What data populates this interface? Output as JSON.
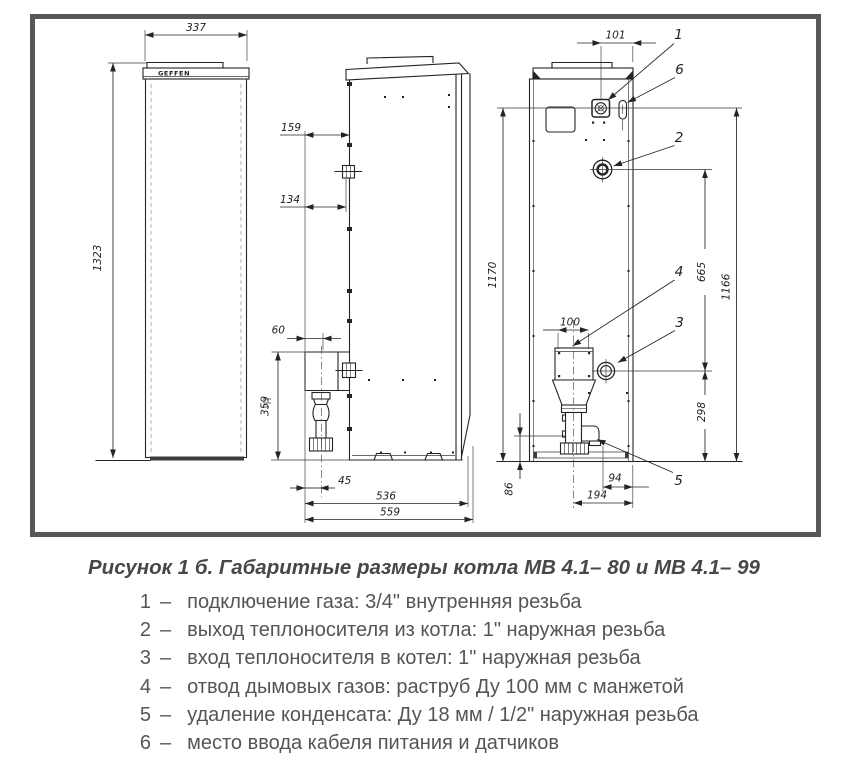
{
  "figure": {
    "border_color": "#58585a",
    "logo": "GEFFEN"
  },
  "dims": {
    "v337": "337",
    "v1323": "1323",
    "v159": "159",
    "v134": "134",
    "v60": "60",
    "v359": "359",
    "v45": "45",
    "v536": "536",
    "v559": "559",
    "v101": "101",
    "v1170": "1170",
    "v665": "665",
    "v1166": "1166",
    "v100": "100",
    "v298": "298",
    "v86": "86",
    "v94": "94",
    "v194": "194"
  },
  "callouts": {
    "n1": "1",
    "n2": "2",
    "n3": "3",
    "n4": "4",
    "n5": "5",
    "n6": "6"
  },
  "caption": {
    "title": "Рисунок 1 б. Габаритные размеры котла МВ 4.1– 80 и МВ 4.1– 99"
  },
  "legend": {
    "separator": "–",
    "items": [
      {
        "num": "1",
        "text": "подключение газа: 3/4\" внутренняя резьба"
      },
      {
        "num": "2",
        "text": "выход теплоносителя из котла: 1\" наружная резьба"
      },
      {
        "num": "3",
        "text": "вход теплоносителя в котел: 1\" наружная резьба"
      },
      {
        "num": "4",
        "text": "отвод дымовых газов: раструб Ду 100 мм с манжетой"
      },
      {
        "num": "5",
        "text": "удаление конденсата: Ду 18 мм / 1/2\" наружная резьба"
      },
      {
        "num": "6",
        "text": "место ввода кабеля питания и датчиков"
      }
    ]
  }
}
